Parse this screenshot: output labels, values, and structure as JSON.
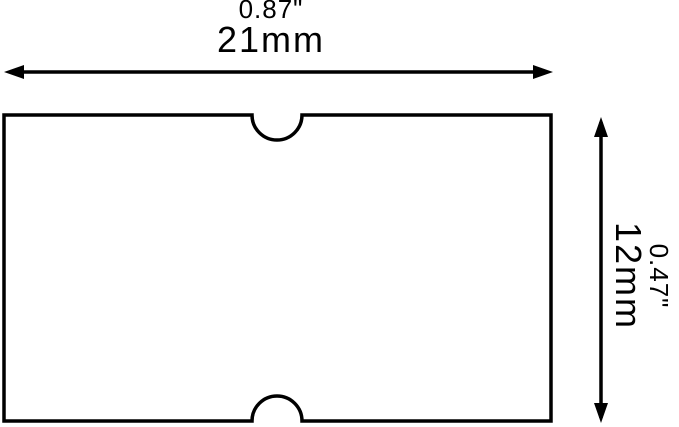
{
  "diagram": {
    "colors": {
      "ink": "#000000",
      "background": "#ffffff"
    },
    "width_dimension": {
      "inches": "0.87\"",
      "mm": "21mm"
    },
    "height_dimension": {
      "inches": "0.47\"",
      "mm": "12mm"
    }
  }
}
